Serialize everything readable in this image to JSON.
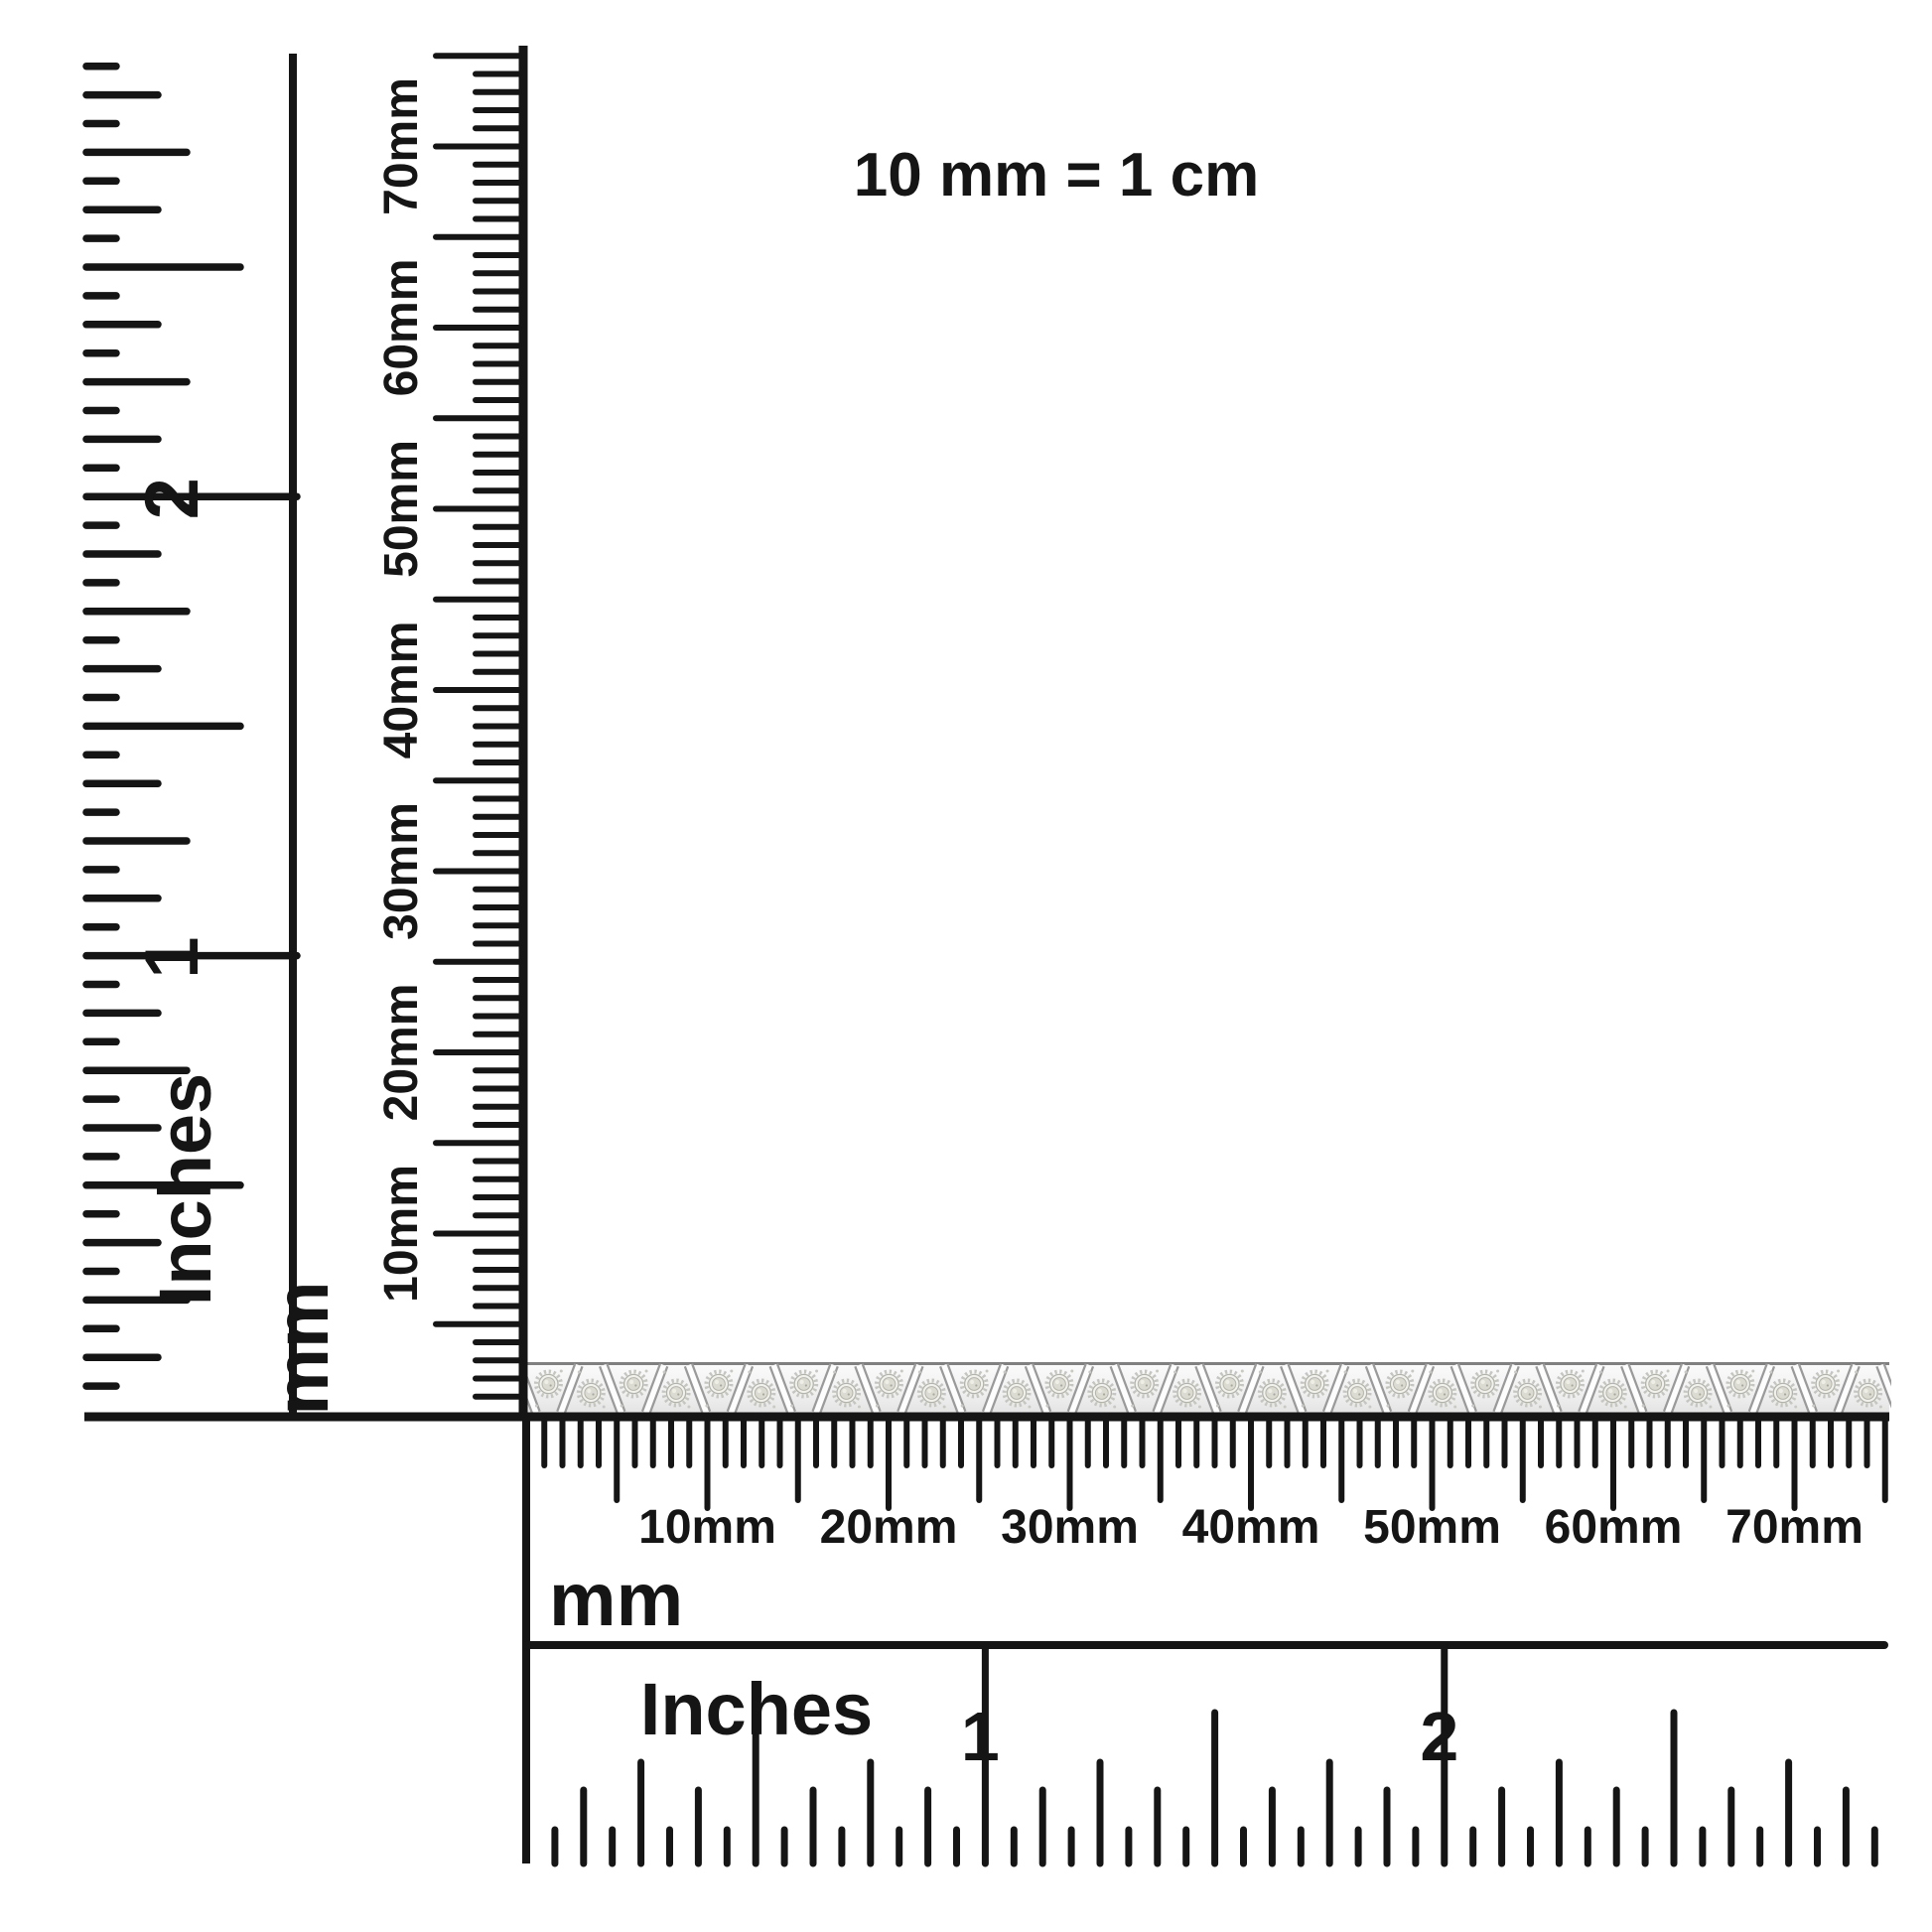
{
  "note": {
    "text": "10 mm = 1 cm"
  },
  "vertical_inch_ruler": {
    "unit_label": "Inches",
    "numbers": [
      "1",
      "2"
    ],
    "subdivision": "1/16 inch"
  },
  "vertical_mm_ruler": {
    "unit_label": "mm",
    "labels": [
      "10mm",
      "20mm",
      "30mm",
      "40mm",
      "50mm",
      "60mm",
      "70mm"
    ],
    "range_mm": 75
  },
  "horizontal_mm_ruler": {
    "unit_label": "mm",
    "labels": [
      "10mm",
      "20mm",
      "30mm",
      "40mm",
      "50mm",
      "60mm",
      "70mm"
    ],
    "range_mm": 75
  },
  "horizontal_inch_ruler": {
    "unit_label": "Inches",
    "numbers": [
      "1",
      "2"
    ],
    "subdivision": "1/16 inch"
  },
  "bracelet": {
    "description": "silver diamond tennis bracelet with alternating trapezoid links and diagonal bars",
    "link_count": 32,
    "metal_color": "#f4f4f4",
    "metal_light": "#fbfbfb",
    "metal_shadow": "#e4e4e4",
    "outline_color": "#8f8f8f",
    "bar_underlay_color": "#9a9a9a",
    "bar_color": "#fdfdfd",
    "plate_color": "#f1f1ed",
    "serration_color": "#c6c6c0",
    "gem_color": "#dbdbd2",
    "gem_edge_color": "#b4b4a9",
    "sparkle_color": "#c9c9c1"
  },
  "colors": {
    "ink": "#151515",
    "background": "#ffffff"
  }
}
